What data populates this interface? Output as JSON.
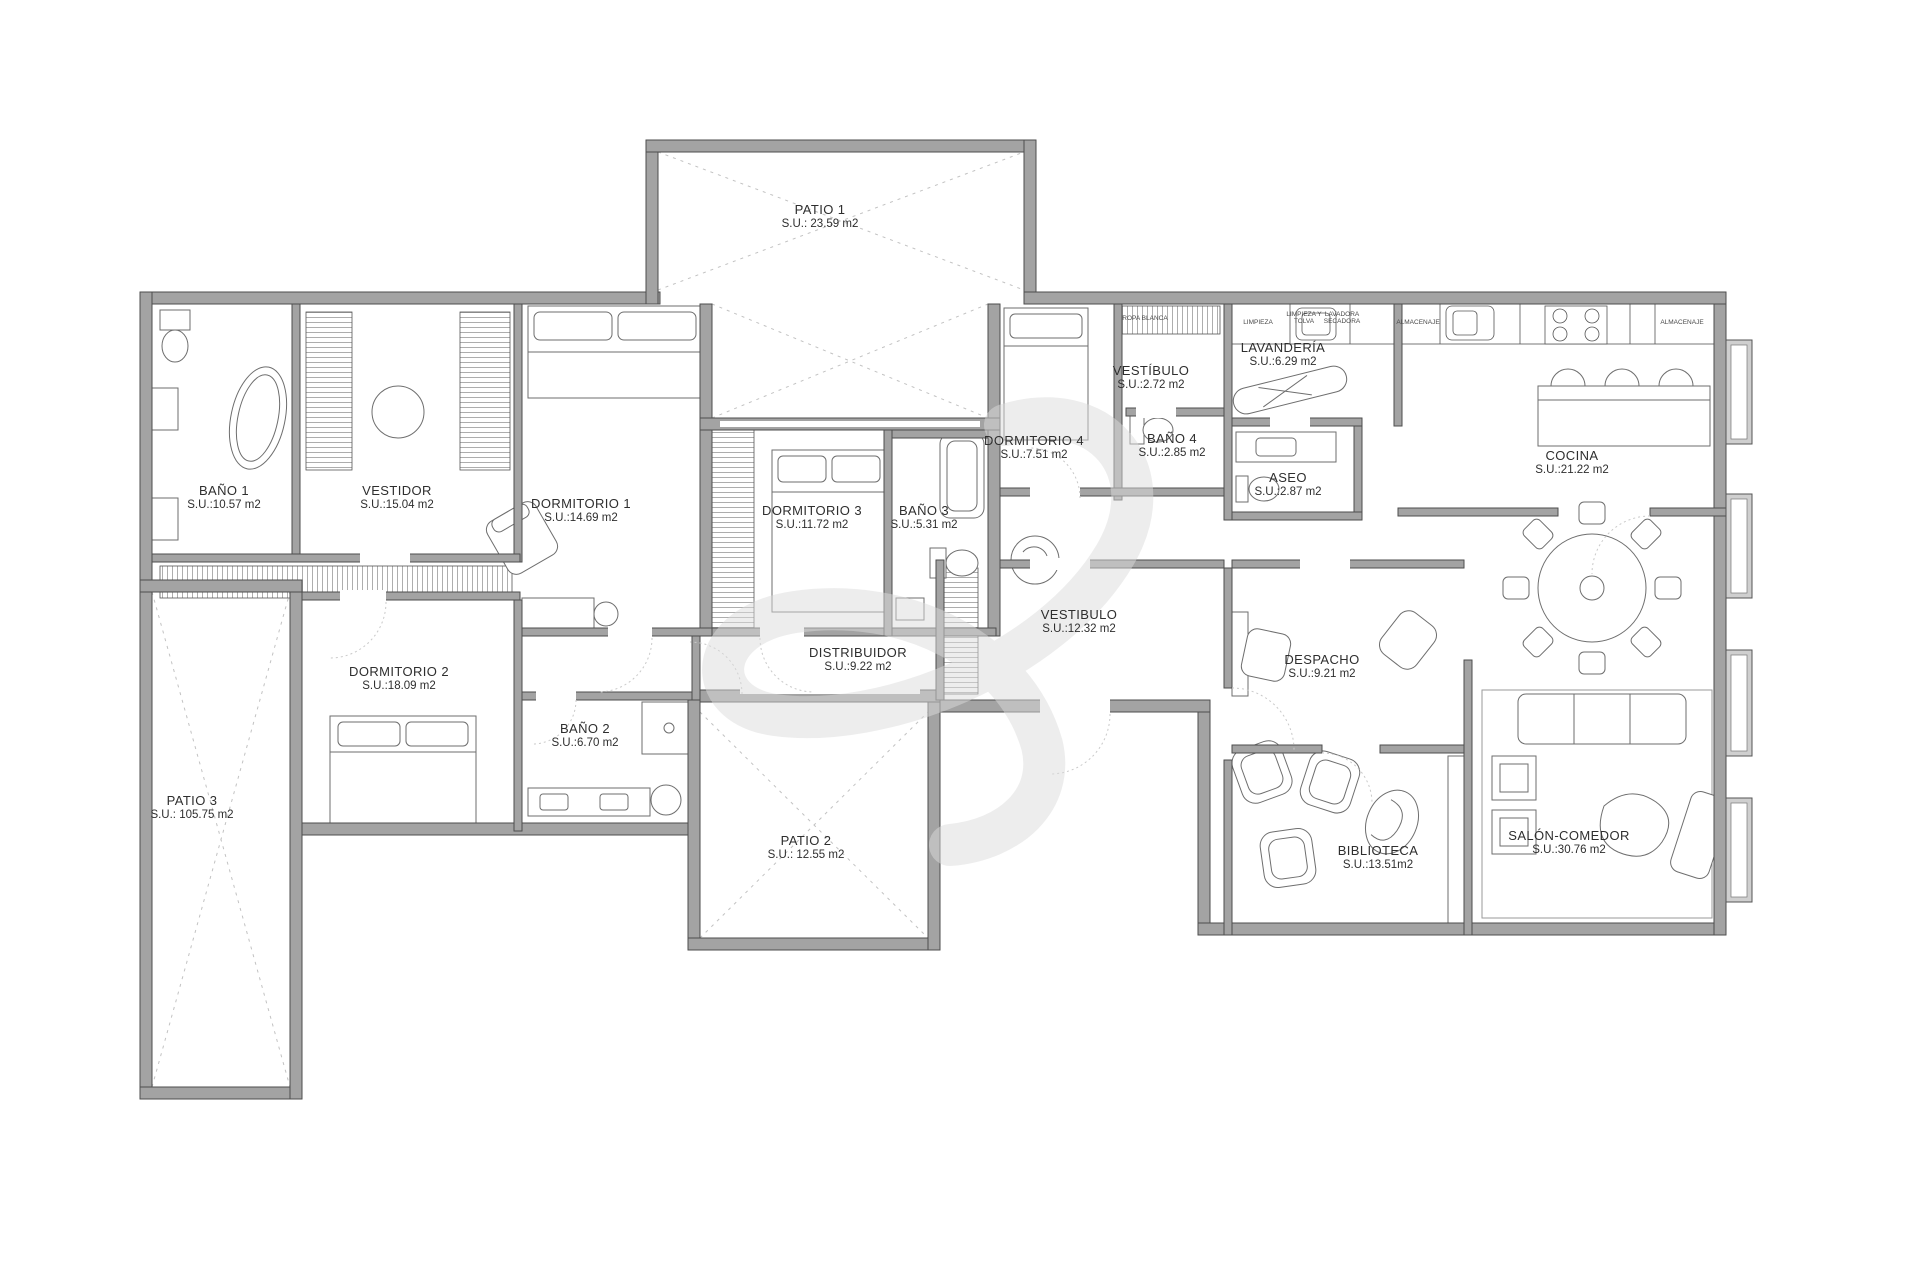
{
  "plan": {
    "rooms": [
      {
        "name": "PATIO 1",
        "area": "S.U.: 23.59 m2"
      },
      {
        "name": "BAÑO 1",
        "area": "S.U.:10.57 m2"
      },
      {
        "name": "VESTIDOR",
        "area": "S.U.:15.04 m2"
      },
      {
        "name": "DORMITORIO 1",
        "area": "S.U.:14.69 m2"
      },
      {
        "name": "DORMITORIO 3",
        "area": "S.U.:11.72 m2"
      },
      {
        "name": "BAÑO 3",
        "area": "S.U.:5.31 m2"
      },
      {
        "name": "DORMITORIO 4",
        "area": "S.U.:7.51 m2"
      },
      {
        "name": "VESTÍBULO",
        "area": "S.U.:2.72 m2"
      },
      {
        "name": "BAÑO 4",
        "area": "S.U.:2.85 m2"
      },
      {
        "name": "LAVANDERÍA",
        "area": "S.U.:6.29 m2"
      },
      {
        "name": "ASEO",
        "area": "S.U.:2.87 m2"
      },
      {
        "name": "COCINA",
        "area": "S.U.:21.22 m2"
      },
      {
        "name": "DORMITORIO 2",
        "area": "S.U.:18.09 m2"
      },
      {
        "name": "BAÑO 2",
        "area": "S.U.:6.70 m2"
      },
      {
        "name": "DISTRIBUIDOR",
        "area": "S.U.:9.22 m2"
      },
      {
        "name": "VESTIBULO",
        "area": "S.U.:12.32 m2"
      },
      {
        "name": "DESPACHO",
        "area": "S.U.:9.21 m2"
      },
      {
        "name": "BIBLIOTECA",
        "area": "S.U.:13.51m2"
      },
      {
        "name": "SALÓN-COMEDOR",
        "area": "S.U.:30.76 m2"
      },
      {
        "name": "PATIO 2",
        "area": "S.U.: 12.55 m2"
      },
      {
        "name": "PATIO 3",
        "area": "S.U.: 105.75 m2"
      }
    ],
    "small_labels": [
      "ROPA BLANCA",
      "LIMPIEZA",
      "LIMPIEZA Y TOLVA",
      "LAVADORA SECADORA",
      "ALMACENAJE",
      "ALMACENAJE"
    ],
    "colors": {
      "wall": "#a3a3a3",
      "wall_outline": "#4e4e4e",
      "line": "#6e6e6e",
      "patio_dash": "#c2c2c2",
      "watermark": "#dcdcdc",
      "background": "#ffffff"
    }
  }
}
